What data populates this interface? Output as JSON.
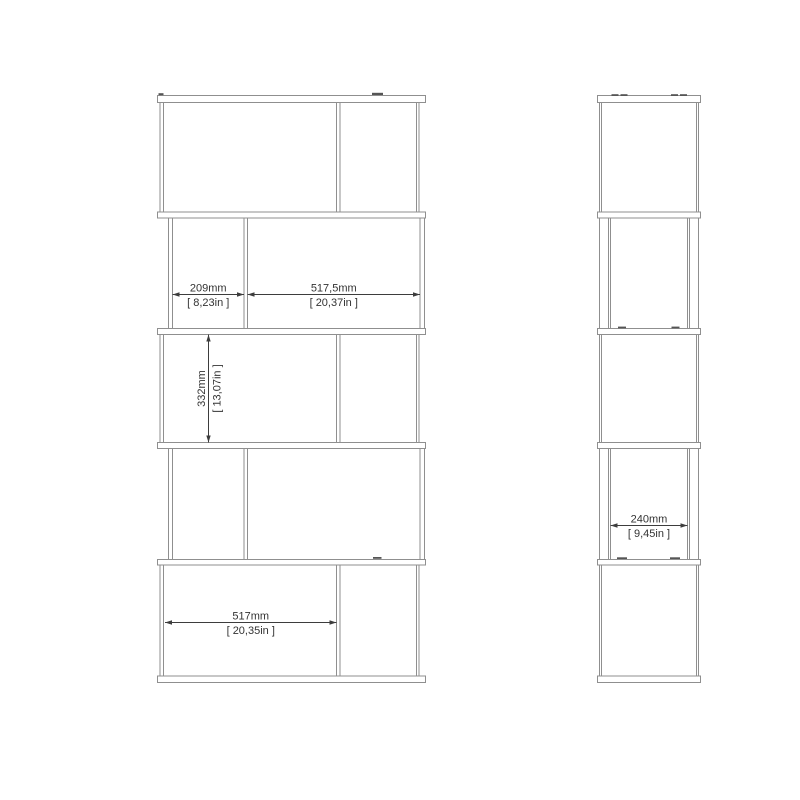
{
  "page": {
    "background_color": "#ffffff"
  },
  "drawing": {
    "colors": {
      "outline": "#8f8f8f",
      "dimension_lines": "#3d3d3d",
      "dimension_text": "#333333"
    },
    "dimensions": {
      "small_opening_width": {
        "mm": "209mm",
        "inches": "[ 8,23in ]"
      },
      "large_opening_width": {
        "mm": "517,5mm",
        "inches": "[ 20,37in ]"
      },
      "opening_height": {
        "mm": "332mm",
        "inches": "[ 13,07in ]"
      },
      "bottom_opening_width": {
        "mm": "517mm",
        "inches": "[ 20,35in ]"
      },
      "side_depth": {
        "mm": "240mm",
        "inches": "[ 9,45in ]"
      }
    }
  }
}
